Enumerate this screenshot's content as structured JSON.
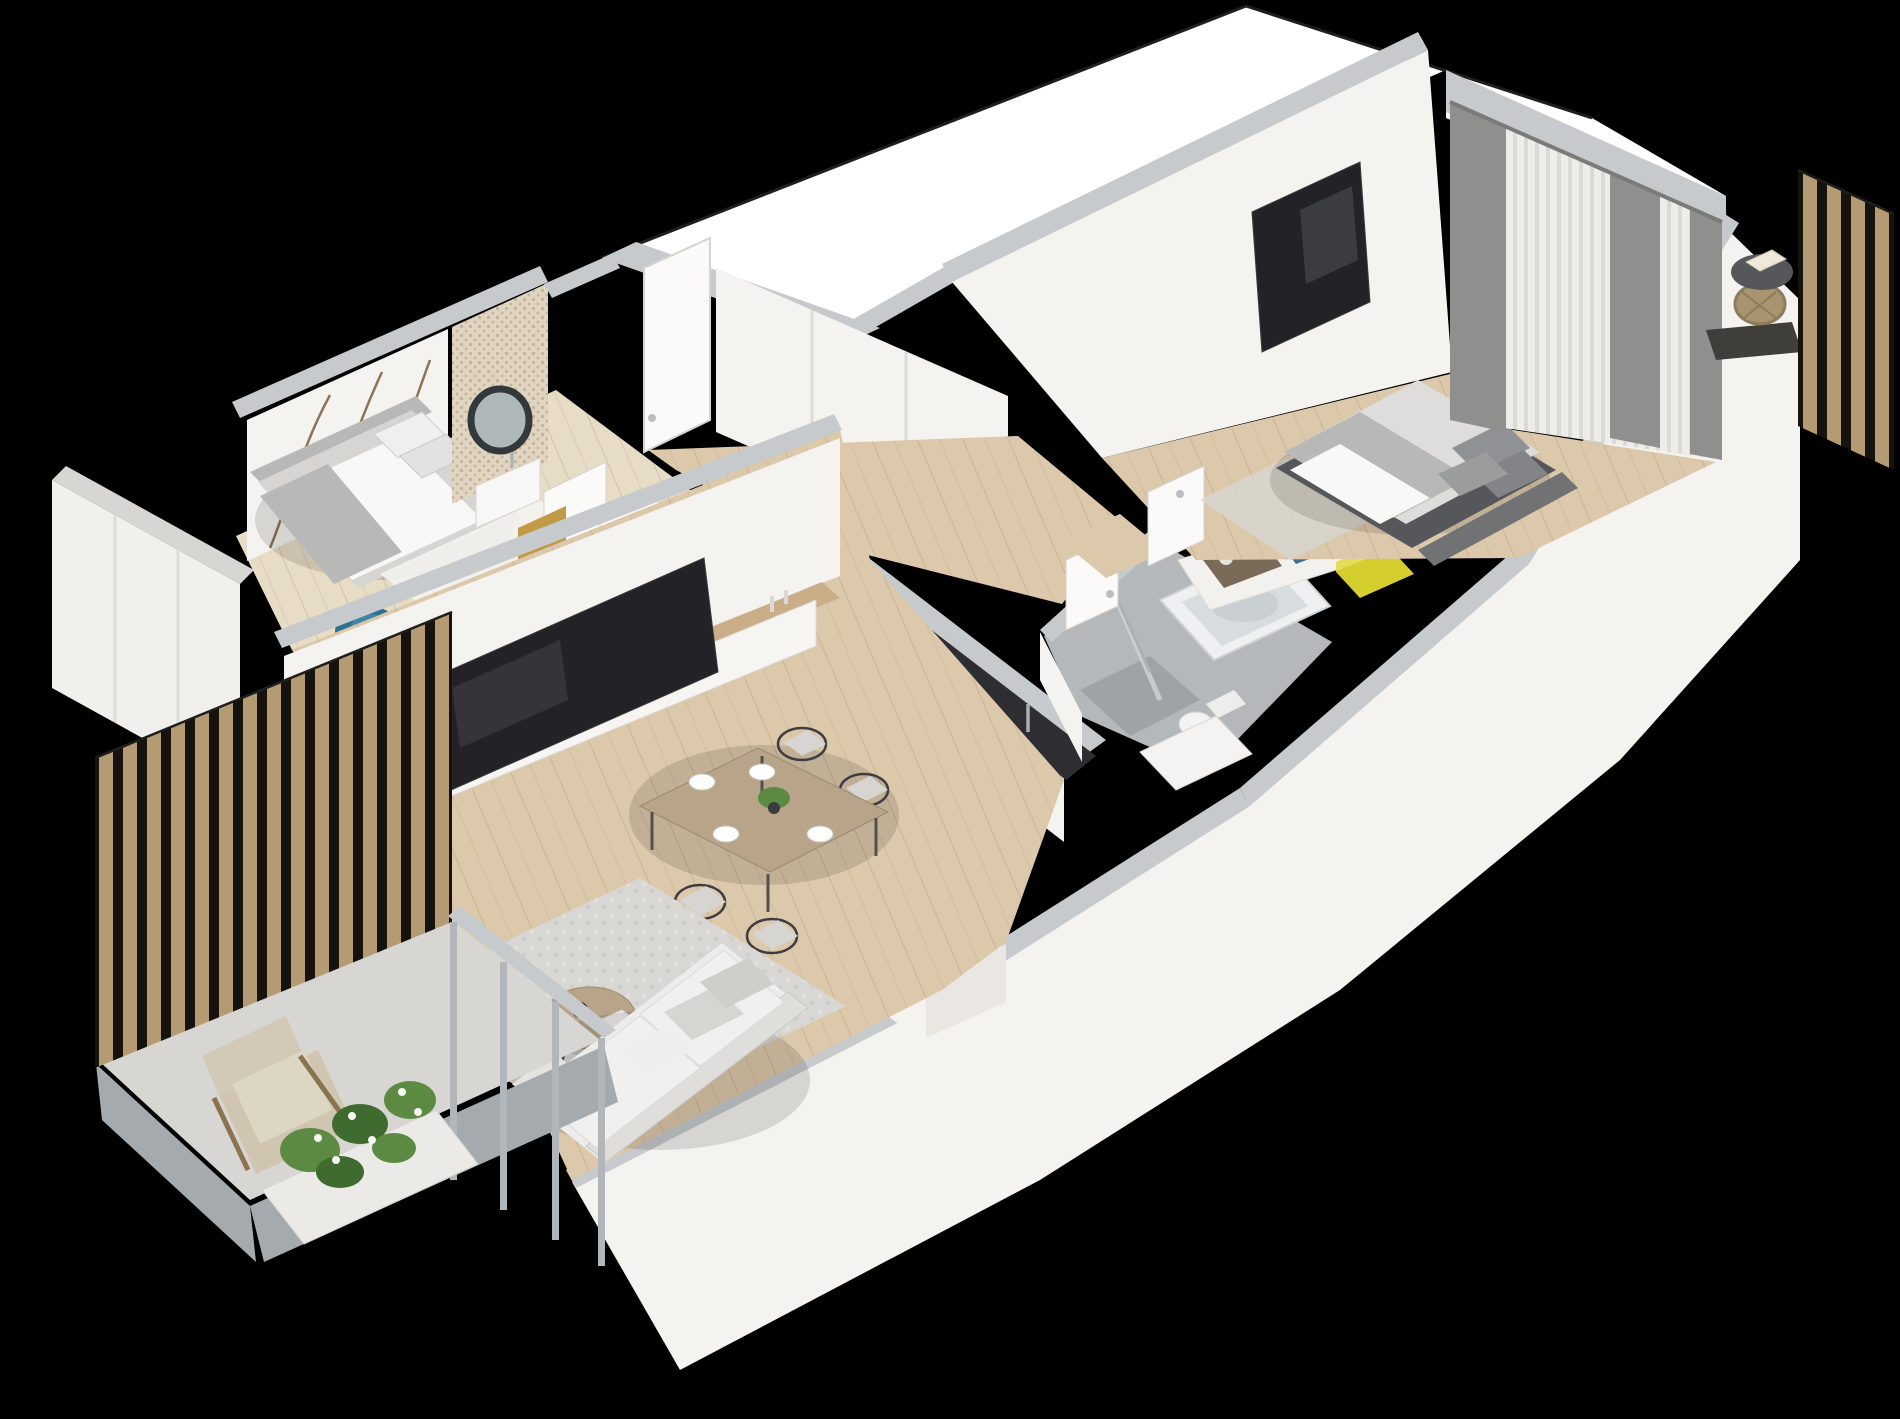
{
  "scene": {
    "kind": "isometric-3d-floor-plan-render",
    "background": "#000000",
    "visible_text": []
  },
  "colors": {
    "bg": "#000000",
    "void": "#ffffff",
    "wall_top": "#c7cacc",
    "wall_top_dark": "#b4b8bb",
    "wall_face": "#f5f3f0",
    "wall_face_shade": "#eae7e2",
    "floor_wood": "#dcc9ab",
    "floor_wood_light": "#e7dcc6",
    "floor_tile": "#d8d6d2",
    "bath_floor": "#b4b8bb",
    "bath_floor_dark": "#9fa3a6",
    "slab": "#a4aaae",
    "rug": "#d8d7d3",
    "rug_white": "#f3f2ef",
    "sofa": "#ececea",
    "sofa_shade": "#dfdedb",
    "cushion": "#d6d5d1",
    "pillow_gray": "#8f9194",
    "counter_dark": "#2e2d31",
    "tv_dark": "#232227",
    "table_wood": "#b7a489",
    "console_wood": "#c9ae87",
    "slat_wood": "#b49b74",
    "slat_gap": "#16130f",
    "mullion": "#b0b6ba",
    "drape": "#8f8f8d",
    "sheer": "#efede9",
    "sheer_stripe": "#dcdad5",
    "bed_platform": "#56575a",
    "mattress": "#dedddb",
    "duvet": "#f8f8f6",
    "headboard": "#707274",
    "blanket_gray": "#b8b9b7",
    "armchair": "#d2c9b6",
    "chair_blue": "#2e7191",
    "clothes_teal": "#3e6f8e",
    "clothes_brown": "#7a6a58",
    "box_yellow": "#d5ce2f",
    "gold": "#c09a45",
    "plant": "#5c8a43",
    "plant_dark": "#3f6b2e",
    "flower": "#f6f6f2",
    "mirror_ring": "#33383b",
    "chrome": "#aab2b6",
    "mosaic_base": "#e0d5c2",
    "mural_branch": "#8d7458",
    "basket": "#a8946f",
    "side_table": "#55575a",
    "tub": "#eef0f1",
    "tub_inner": "#d7dcde",
    "steel": "#b9bec2",
    "door": "#fbfaf8",
    "door_stroke": "#d6d4d0",
    "island_dark": "#2b2b2f",
    "wardrobe_face": "#f2f0ed",
    "black_line": "#1e1e1c"
  },
  "rooms": [
    {
      "name": "small-bedroom",
      "items": [
        "wardrobe",
        "single-bed",
        "pillows",
        "gray-throw-blanket",
        "tree-branch-mural-wall",
        "white-rug",
        "desk",
        "blue-tub-chair",
        "door"
      ]
    },
    {
      "name": "powder-room",
      "items": [
        "mosaic-feature-wall",
        "round-mirror",
        "washbasin",
        "brass-vanity"
      ]
    },
    {
      "name": "entry-hall",
      "items": [
        "entrance-door",
        "built-in-closets",
        "corridor"
      ]
    },
    {
      "name": "kitchen",
      "items": [
        "cabinet-run",
        "dark-countertop",
        "dishwasher",
        "sink",
        "faucet",
        "fruit-bowl",
        "island-peninsula",
        "hob",
        "cups"
      ]
    },
    {
      "name": "dining-area",
      "items": [
        "wood-table",
        "wire-chairs",
        "place-settings",
        "centerpiece-plant"
      ]
    },
    {
      "name": "living-room",
      "items": [
        "tv-wall",
        "media-console",
        "television",
        "potted-plant",
        "area-rug",
        "round-coffee-table",
        "sofa",
        "throw-pillows"
      ]
    },
    {
      "name": "bathroom",
      "items": [
        "bathtub",
        "shower",
        "glass-screen",
        "toilet",
        "vanity",
        "door"
      ]
    },
    {
      "name": "hallway",
      "items": [
        "open-wardrobe",
        "hanging-clothes",
        "yellow-storage-box",
        "bedroom-door"
      ]
    },
    {
      "name": "master-bedroom",
      "items": [
        "double-bed",
        "pillows",
        "wall-tv",
        "sheer-curtains",
        "gray-drapes",
        "rug"
      ]
    },
    {
      "name": "balcony-left",
      "items": [
        "timber-slat-screen",
        "glazing-mullions",
        "armchair",
        "planter-with-flowers",
        "concrete-slab"
      ]
    },
    {
      "name": "balcony-right",
      "items": [
        "timber-slat-screen",
        "round-side-table",
        "wicker-basket",
        "book"
      ]
    }
  ]
}
